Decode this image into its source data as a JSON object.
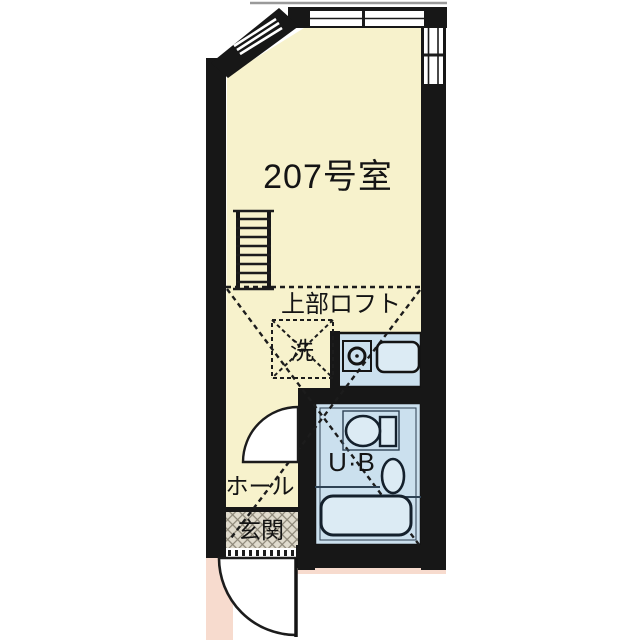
{
  "plan": {
    "room_number": "207号室",
    "loft_label": "上部ロフト",
    "washer_label": "洗",
    "unit_bath_label": "U·B",
    "hall_label": "ホール",
    "entrance_label": "玄関"
  },
  "colors": {
    "wall": "#171717",
    "line": "#1c1c1c",
    "room_fill": "#f7f2cc",
    "wet_area_fill": "#cbe0ee",
    "fixture_fill": "#dcebf4",
    "walkway_fill": "#f7dbce",
    "entrance_hatch_base": "#e0dbcd",
    "entrance_hatch_line": "#8b8576",
    "balcony_line": "#9a9a9a"
  },
  "icons": {
    "ladder": "loft-ladder-icon",
    "washer_space": "washer-space-icon",
    "sink": "sink-icon",
    "toilet": "toilet-icon",
    "washbasin": "washbasin-icon",
    "bathtub": "bathtub-icon",
    "bath_door": "bath-door-arc-icon",
    "entrance_door": "entrance-door-arc-icon"
  }
}
